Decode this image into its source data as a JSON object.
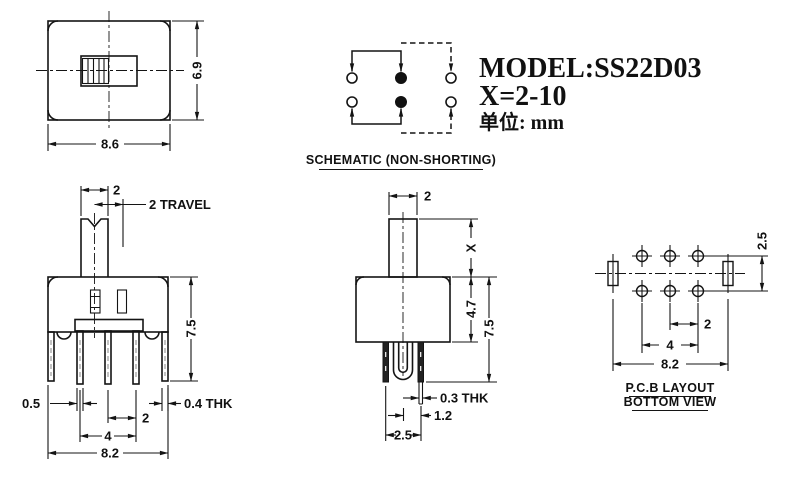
{
  "title_block": {
    "model": "MODEL:SS22D03",
    "x_range": "X=2-10",
    "unit_label": "单位: mm"
  },
  "schematic": {
    "title": "SCHEMATIC (NON-SHORTING)"
  },
  "top_view": {
    "width": "8.6",
    "height": "6.9"
  },
  "front_view": {
    "knob_width": "2",
    "travel": "2 TRAVEL",
    "total_height": "7.5",
    "terminal_width": "0.5",
    "bracket_thickness": "0.4 THK",
    "terminal_pitch": "2",
    "terminal_span": "4",
    "base_width": "8.2"
  },
  "side_view": {
    "knob_width": "2",
    "knob_height": "X",
    "body_height": "4.7",
    "total_height": "7.5",
    "terminal_thickness": "0.3 THK",
    "terminal_offset": "1.2",
    "terminal_pitch": "2.5"
  },
  "pcb_view": {
    "row_pitch": "2.5",
    "hole_pitch": "2",
    "hole_span": "4",
    "overall_span": "8.2",
    "title_line1": "P.C.B LAYOUT",
    "title_line2": "BOTTOM VIEW"
  }
}
